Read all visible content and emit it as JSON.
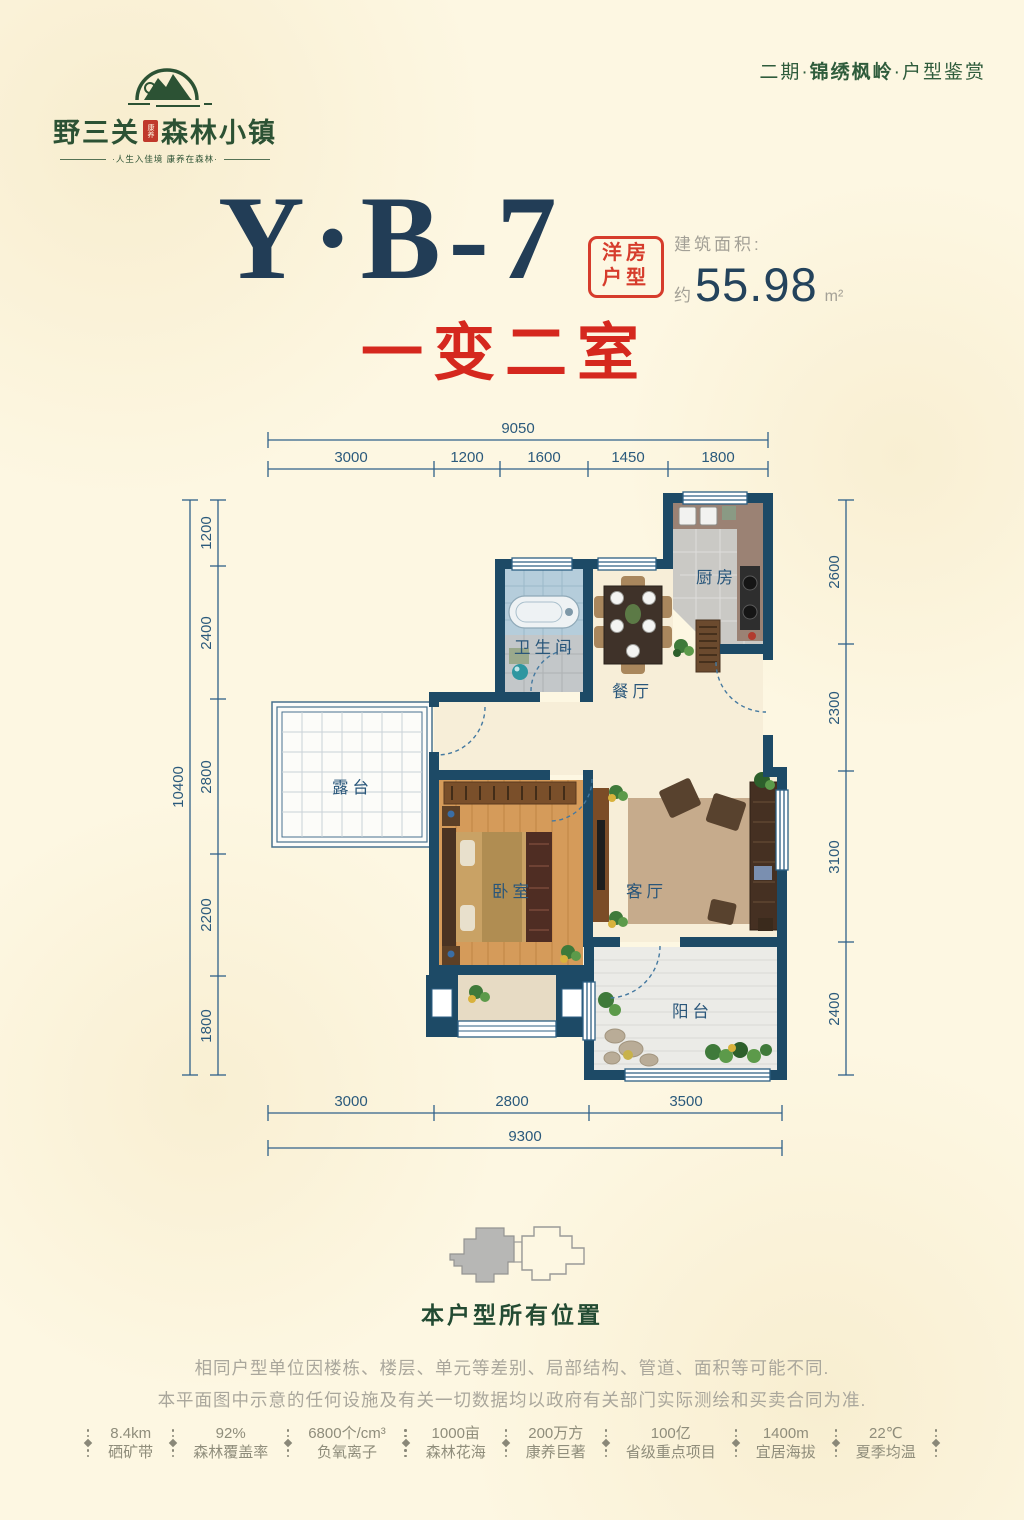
{
  "header": {
    "logo_pre": "野三关",
    "logo_seal": "康养",
    "logo_post": "森林小镇",
    "logo_tagline": "·人生入佳境  康养在森林·",
    "edition_pre": "二期·",
    "edition_highlight": "锦绣枫岭",
    "edition_post": "·户型鉴赏"
  },
  "title": {
    "unit": "Y·B-7",
    "stamp_top": "洋房",
    "stamp_bottom": "户型",
    "area_label": "建筑面积:",
    "area_approx": "约",
    "area_value": "55.98",
    "area_unit": "m²",
    "subtitle": "一变二室"
  },
  "floorplan": {
    "rooms": {
      "kitchen": "厨房",
      "bathroom": "卫生间",
      "dining": "餐厅",
      "terrace": "露台",
      "bedroom": "卧室",
      "living": "客厅",
      "balcony": "阳台"
    },
    "dim_top_total": "9050",
    "dim_top": [
      "3000",
      "1200",
      "1600",
      "1450",
      "1800"
    ],
    "dim_left_total": "10400",
    "dim_left": [
      "1200",
      "2400",
      "2800",
      "2200",
      "1800"
    ],
    "dim_right": [
      "2600",
      "2300",
      "3100",
      "2400"
    ],
    "dim_bottom": [
      "3000",
      "2800",
      "3500"
    ],
    "dim_bottom_total": "9300"
  },
  "locator": {
    "caption": "本户型所有位置"
  },
  "disclaimer": {
    "line1": "相同户型单位因楼栋、楼层、单元等差别、局部结构、管道、面积等可能不同.",
    "line2": "本平面图中示意的任何设施及有关一切数据均以政府有关部门实际测绘和买卖合同为准."
  },
  "stats": [
    {
      "value": "8.4km",
      "label": "硒矿带"
    },
    {
      "value": "92%",
      "label": "森林覆盖率"
    },
    {
      "value": "6800个/cm³",
      "label": "负氧离子"
    },
    {
      "value": "1000亩",
      "label": "森林花海"
    },
    {
      "value": "200万方",
      "label": "康养巨著"
    },
    {
      "value": "100亿",
      "label": "省级重点项目"
    },
    {
      "value": "1400m",
      "label": "宜居海拔"
    },
    {
      "value": "22℃",
      "label": "夏季均温"
    }
  ]
}
